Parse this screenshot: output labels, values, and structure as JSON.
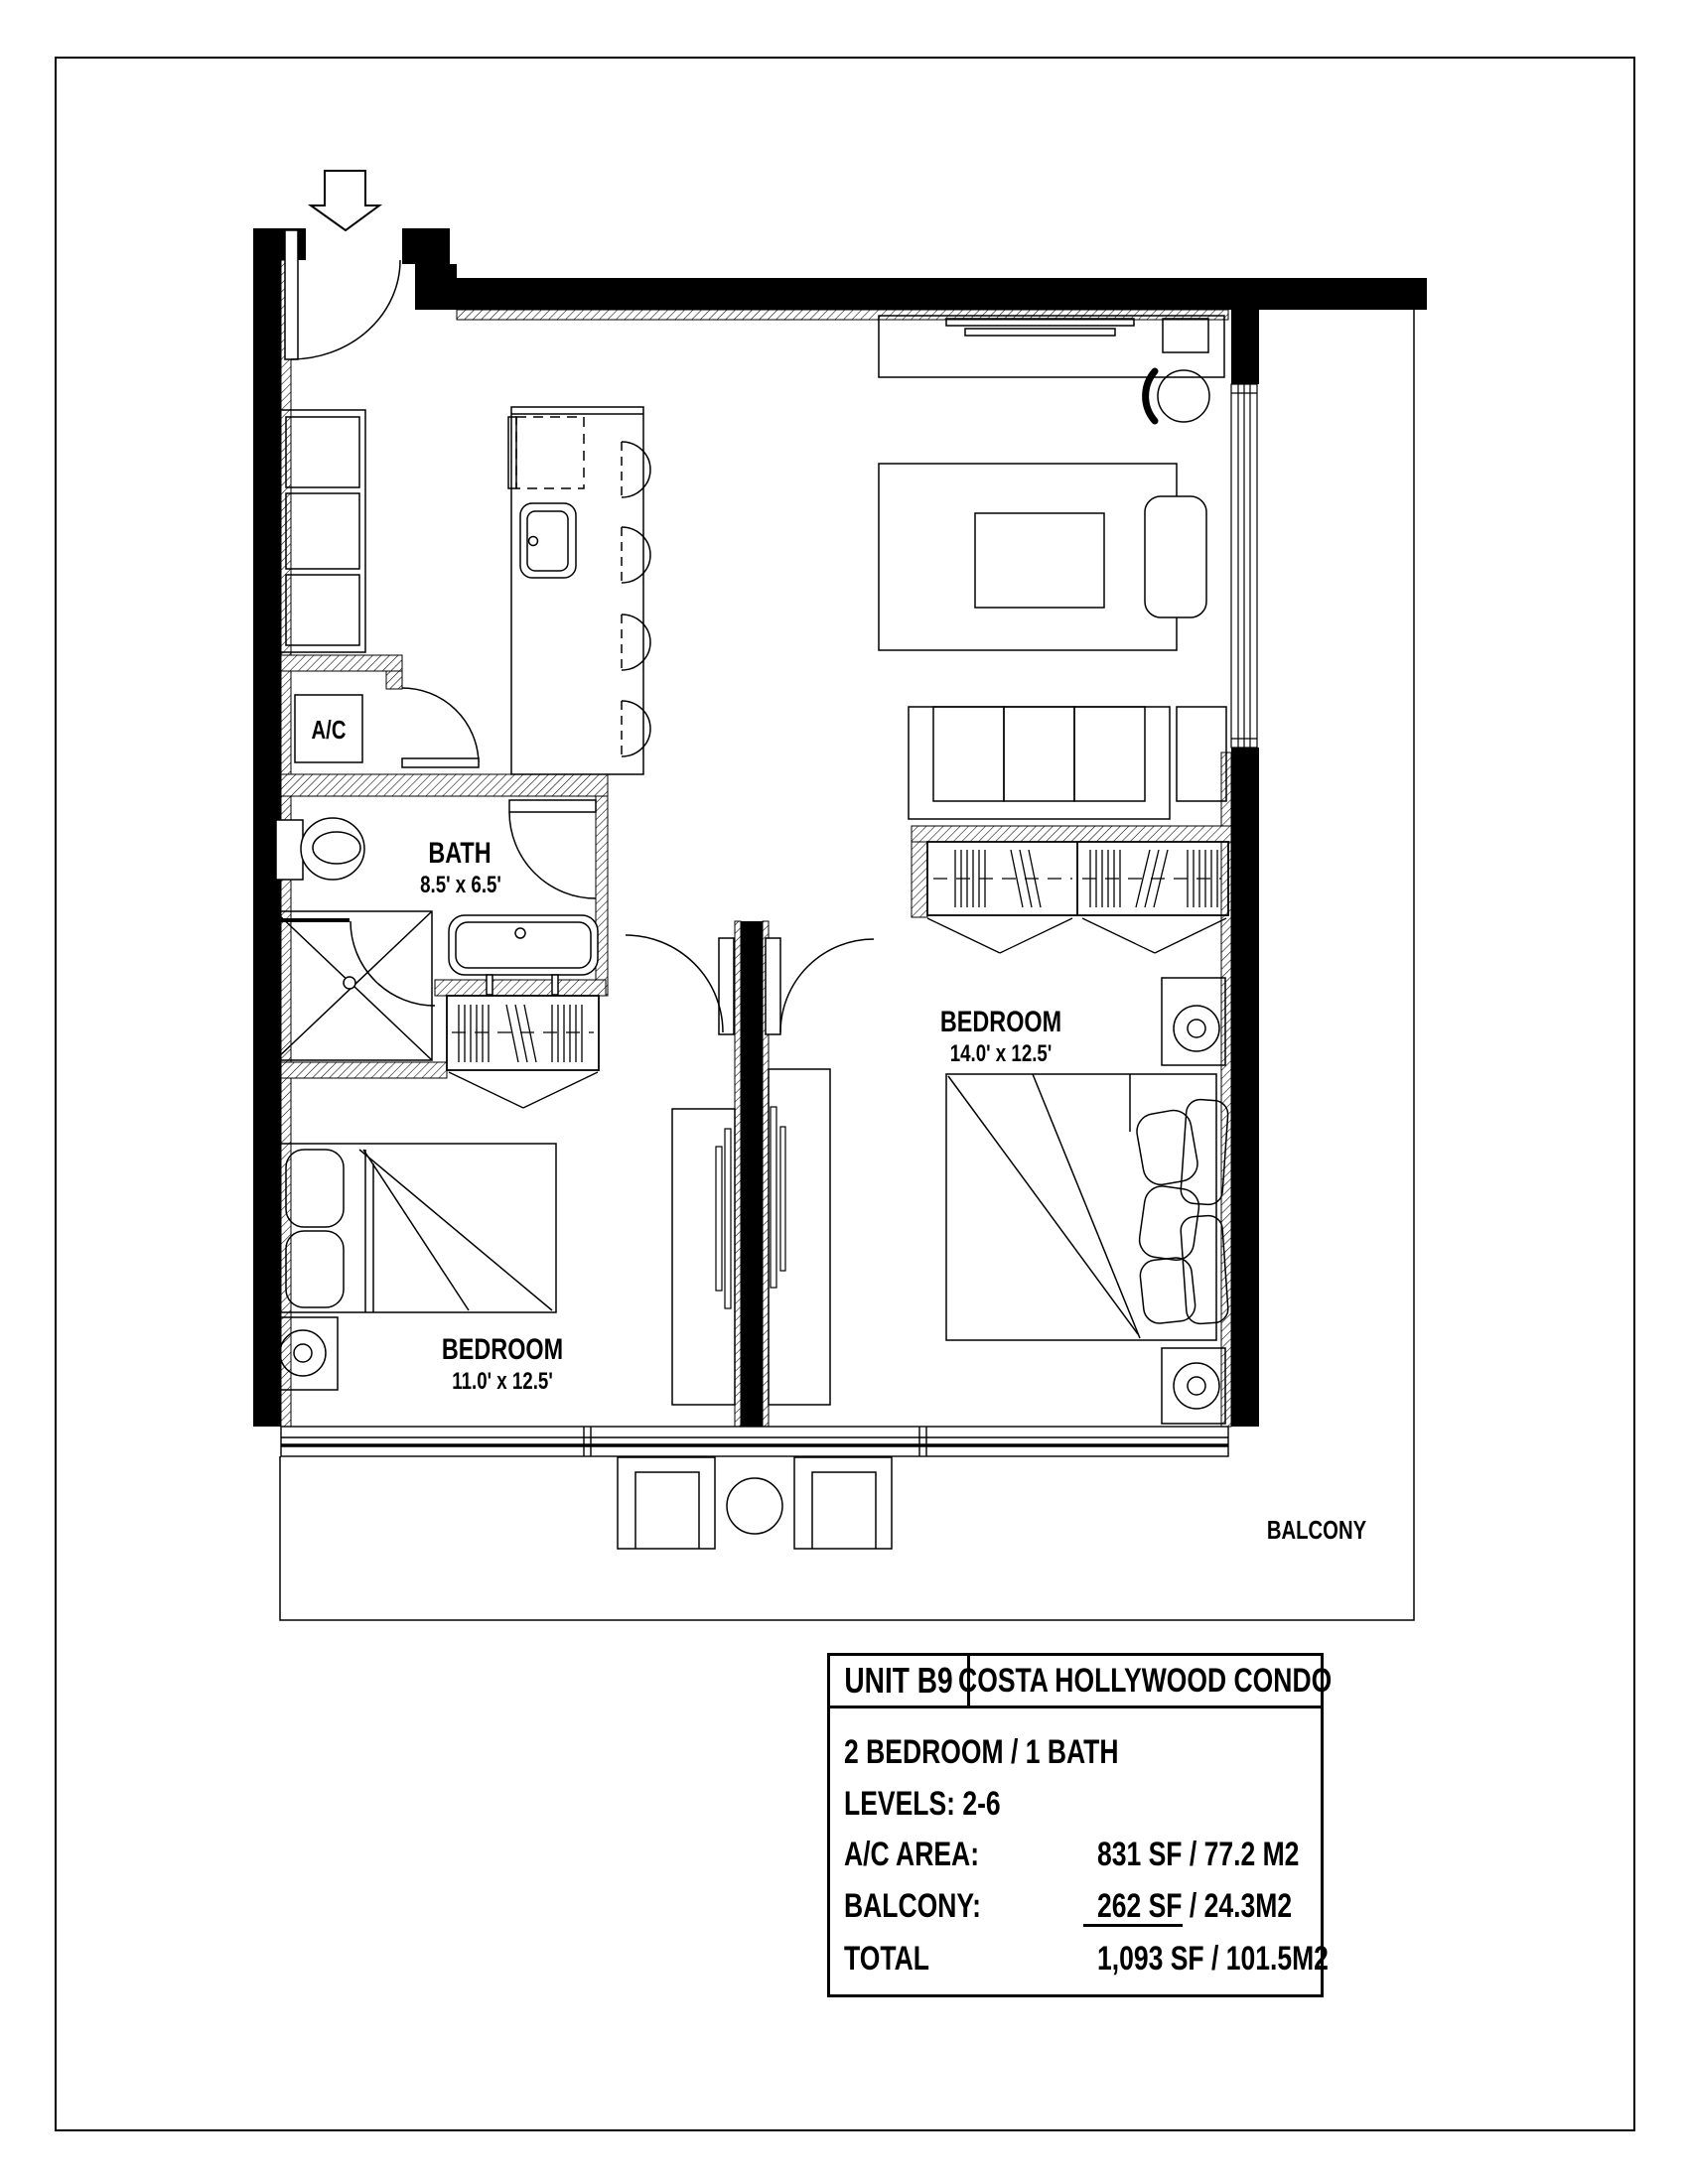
{
  "floor_plan": {
    "rooms": {
      "bath": {
        "name": "BATH",
        "dims": "8.5' x 6.5'"
      },
      "bedroom_right": {
        "name": "BEDROOM",
        "dims": "14.0' x 12.5'"
      },
      "bedroom_left": {
        "name": "BEDROOM",
        "dims": "11.0' x 12.5'"
      },
      "balcony": {
        "name": "BALCONY"
      },
      "ac_closet": {
        "name": "A/C"
      }
    }
  },
  "info_table": {
    "unit": "UNIT B9",
    "building": "COSTA HOLLYWOOD CONDO",
    "rows": [
      {
        "label": "2 BEDROOM / 1 BATH",
        "value": ""
      },
      {
        "label": "LEVELS:  2-6",
        "value": ""
      },
      {
        "label": "A/C AREA:",
        "value": "831 SF /  77.2 M2"
      },
      {
        "label": "BALCONY:",
        "value": "262 SF /  24.3M2"
      },
      {
        "label": "TOTAL",
        "value": "1,093 SF /  101.5M2"
      }
    ]
  }
}
